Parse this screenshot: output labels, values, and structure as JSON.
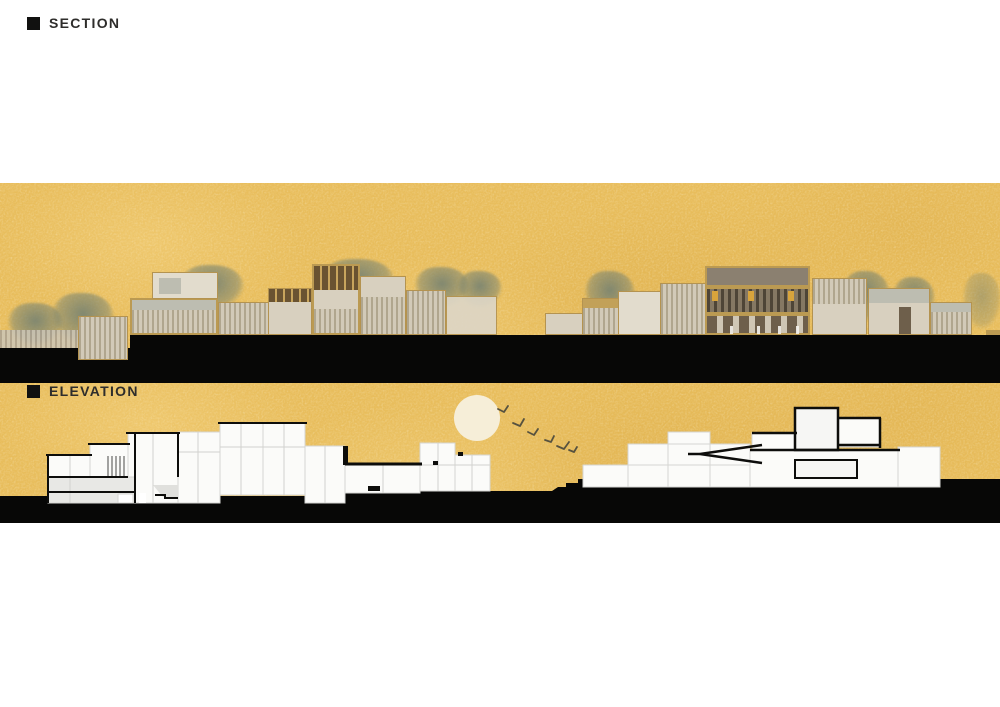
{
  "page": {
    "background": "#ffffff",
    "kind": "architectural presentation sheet"
  },
  "panels": {
    "elevation": {
      "label": "ELEVATION",
      "marker_icon": "black-square-icon"
    },
    "section": {
      "label": "SECTION",
      "marker_icon": "black-square-icon"
    }
  },
  "scene": {
    "sun_visible": true,
    "bird_count": 6,
    "elevation_building_clusters": 2,
    "section_building_clusters": 2
  },
  "colors": {
    "band_background": "#e8bd5c",
    "ground_black": "#070706",
    "label_ink": "#2e2d2b",
    "sun": "#f6eed8",
    "bird": "#57523f",
    "section_wall_black": "#0d0d0b",
    "room_fill": "#fbfbf9",
    "room_outline": "#d6d6d2",
    "frame_tan": "#bb9a52",
    "panel_beige": "#d8d0bf",
    "tree_green": "#788371"
  }
}
